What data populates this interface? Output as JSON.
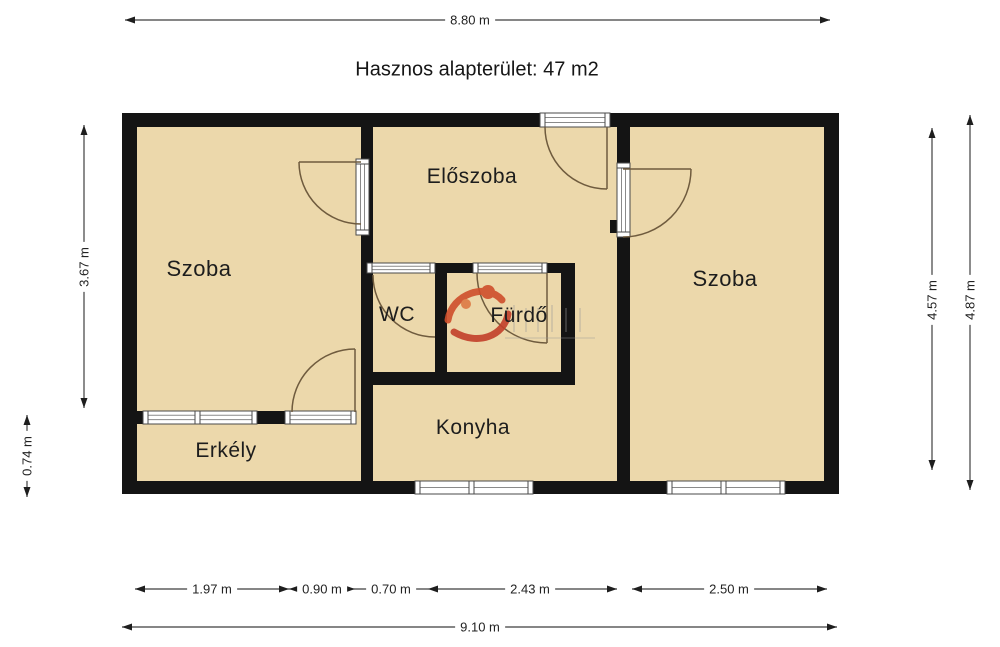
{
  "title": "Hasznos alapterület: 47 m2",
  "rooms": {
    "room_left": "Szoba",
    "hall": "Előszoba",
    "wc": "WC",
    "bath": "Fürdő",
    "kitchen": "Konyha",
    "balcony": "Erkély",
    "room_right": "Szoba"
  },
  "dimensions": {
    "top_width": "8.80 m",
    "left_room_height": "3.67 m",
    "balcony_height": "0.74 m",
    "right_inner_height": "4.57 m",
    "right_outer_height": "4.87 m",
    "bottom_segments": [
      "1.97 m",
      "0.90 m",
      "0.70 m",
      "2.43 m",
      "2.50 m"
    ],
    "bottom_total": "9.10 m"
  },
  "watermark": {
    "logo_icon": "ingatlan-watermark-logo-icon"
  },
  "colors": {
    "floor": "#ecd8ab",
    "wall": "#141414",
    "window_frame": "#4a4a4a",
    "door_arc": "#6f5b3e",
    "dimension_line": "#3f3f3f",
    "logo_orange": "#cf4e2b"
  }
}
